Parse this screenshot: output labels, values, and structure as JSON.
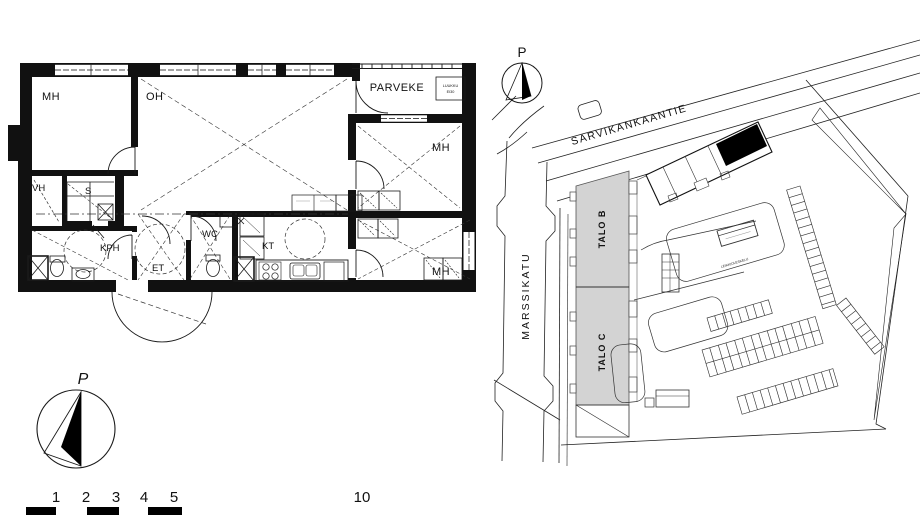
{
  "floor_plan": {
    "rooms": {
      "mh_top_left": "MH",
      "oh": "OH",
      "parveke": "PARVEKE",
      "mh_top_right": "MH",
      "mh_bottom_right": "MH",
      "vh": "VH",
      "sauna": "S",
      "kph": "KPH",
      "et": "ET",
      "wc": "WC",
      "kt": "KT"
    },
    "hatch_box": {
      "line1": "LUUKKU",
      "line2": "EI30"
    },
    "compass_label": "P"
  },
  "site_plan": {
    "compass_label": "P",
    "streets": {
      "top": "SARVIKANKAANTIE",
      "left": "MARSSIKATU"
    },
    "buildings": {
      "talo_b": "TALO B",
      "talo_c": "TALO C"
    },
    "labels": {
      "play_area": "LEIKKIOLESKELU"
    },
    "colors": {
      "building_fill": "#d3d3d3",
      "highlight": "#000000"
    }
  },
  "scale_bar": {
    "labels": [
      "1",
      "2",
      "3",
      "4",
      "5",
      "10"
    ]
  }
}
